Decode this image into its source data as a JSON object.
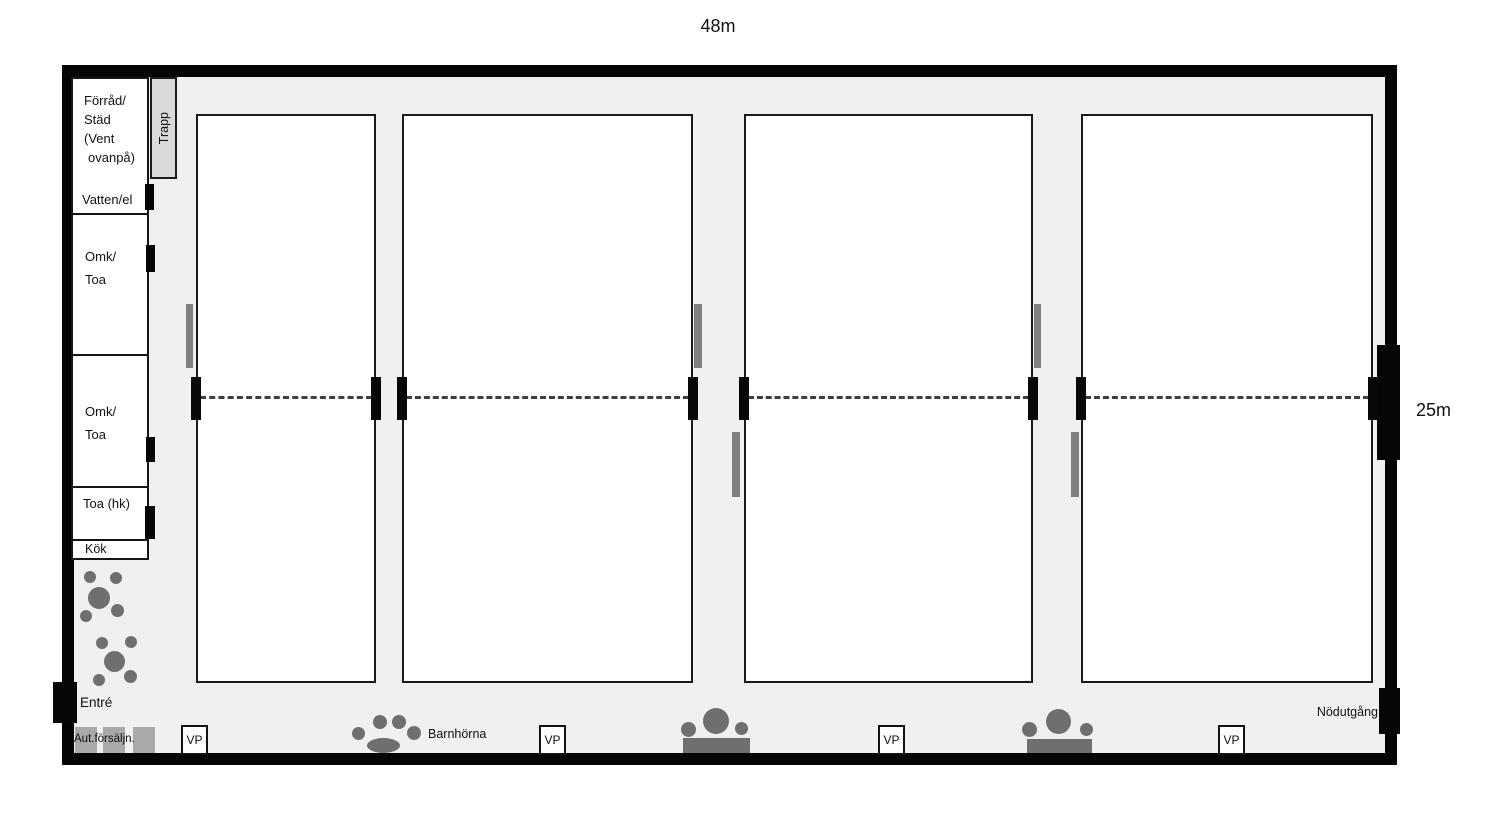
{
  "dimensions": {
    "width": "48m",
    "height": "25m"
  },
  "stairs": {
    "label": "Trapp"
  },
  "rooms": [
    {
      "name": "storage",
      "lines": [
        "Förråd/",
        "Städ",
        "(Vent",
        "ovanpå)"
      ],
      "sub_label": "Vatten/el"
    },
    {
      "name": "changing-room-1",
      "lines": [
        "Omk/",
        "Toa"
      ]
    },
    {
      "name": "changing-room-2",
      "lines": [
        "Omk/",
        "Toa"
      ]
    },
    {
      "name": "toilet-accessible",
      "label": "Toa (hk)"
    },
    {
      "name": "kitchen",
      "label": "Kök"
    }
  ],
  "entrance": {
    "label": "Entré"
  },
  "vending_machines": {
    "label": "Aut.försäljn."
  },
  "kids_corner": {
    "label": "Barnhörna"
  },
  "emergency_exit": {
    "label": "Nödutgång"
  },
  "vp": {
    "label": "VP"
  },
  "courts": {
    "count": 4
  }
}
